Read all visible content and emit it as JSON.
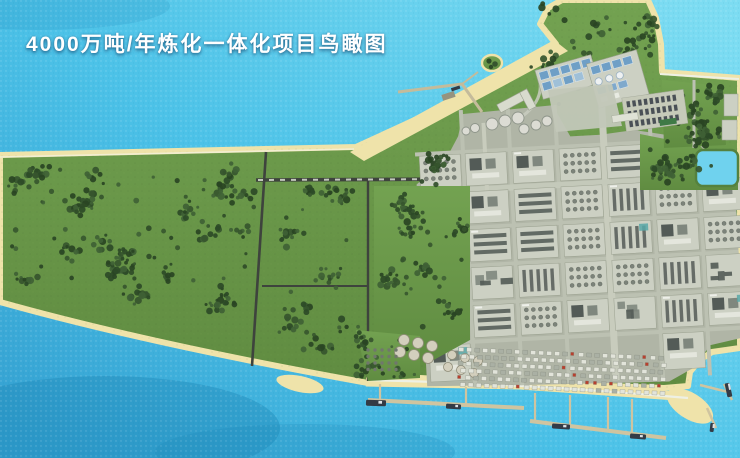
{
  "title": "4000万吨/年炼化一体化项目鸟瞰图",
  "colors": {
    "ocean": "#45bfe6",
    "ocean_light": "#7edcf2",
    "ocean_deep": "#1d86b6",
    "lagoon": "#6fd2ee",
    "sand": "#efe3aa",
    "grass": "#6b9a4a",
    "grass_dark": "#57833c",
    "tree": "#2e4b28",
    "road_dark": "#3e433d",
    "road_light": "#bcc1b2",
    "pad": "#ccd0c3",
    "ground": "#b0b5a6",
    "unit_dark": "#535b57",
    "unit_mid": "#7f877e",
    "unit_light": "#e4e6dd",
    "tank": "#d9d8cd",
    "pier": "#cfc4a0",
    "seawall": "#eef0e4",
    "ship": "#333b46",
    "pool": "#6f9fc6",
    "pool_light": "#9fc0d8",
    "teal": "#58a8a8",
    "accent_red": "#b8402e",
    "title_color": "#ffffff"
  }
}
